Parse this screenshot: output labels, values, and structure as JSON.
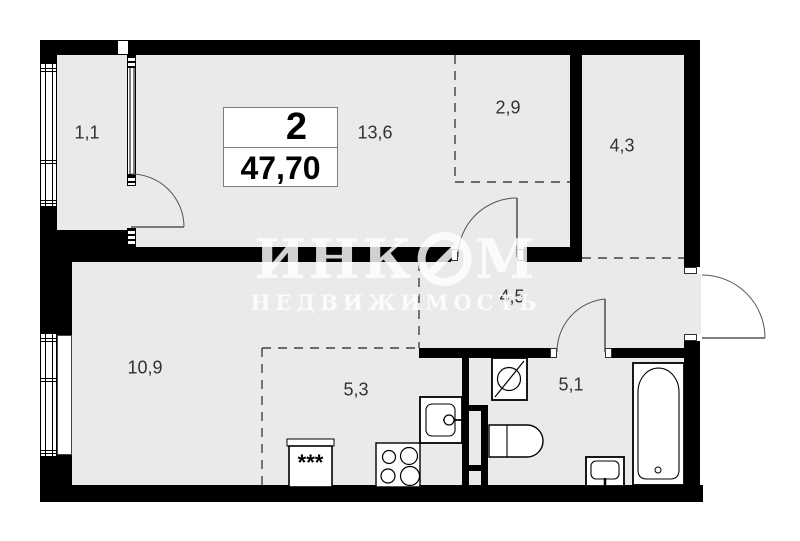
{
  "plan": {
    "rooms_count": "2",
    "total_area": "47,70",
    "room_areas": {
      "balcony": "1,1",
      "living_kitchen": "13,6",
      "wardrobe": "2,9",
      "room_small": "4,3",
      "hallway": "4,5",
      "living_zone": "10,9",
      "kitchen_zone": "5,3",
      "bathroom": "5,1"
    },
    "watermark": {
      "brand_prefix": "ИНК",
      "brand_suffix": "М",
      "subtitle": "НЕДВИЖИМОСТЬ"
    },
    "fridge_symbol": "***",
    "colors": {
      "floor": "#e8eaec",
      "wall": "#000000",
      "watermark": "#ffffff",
      "dashed_line": "#3f3f3f"
    }
  }
}
